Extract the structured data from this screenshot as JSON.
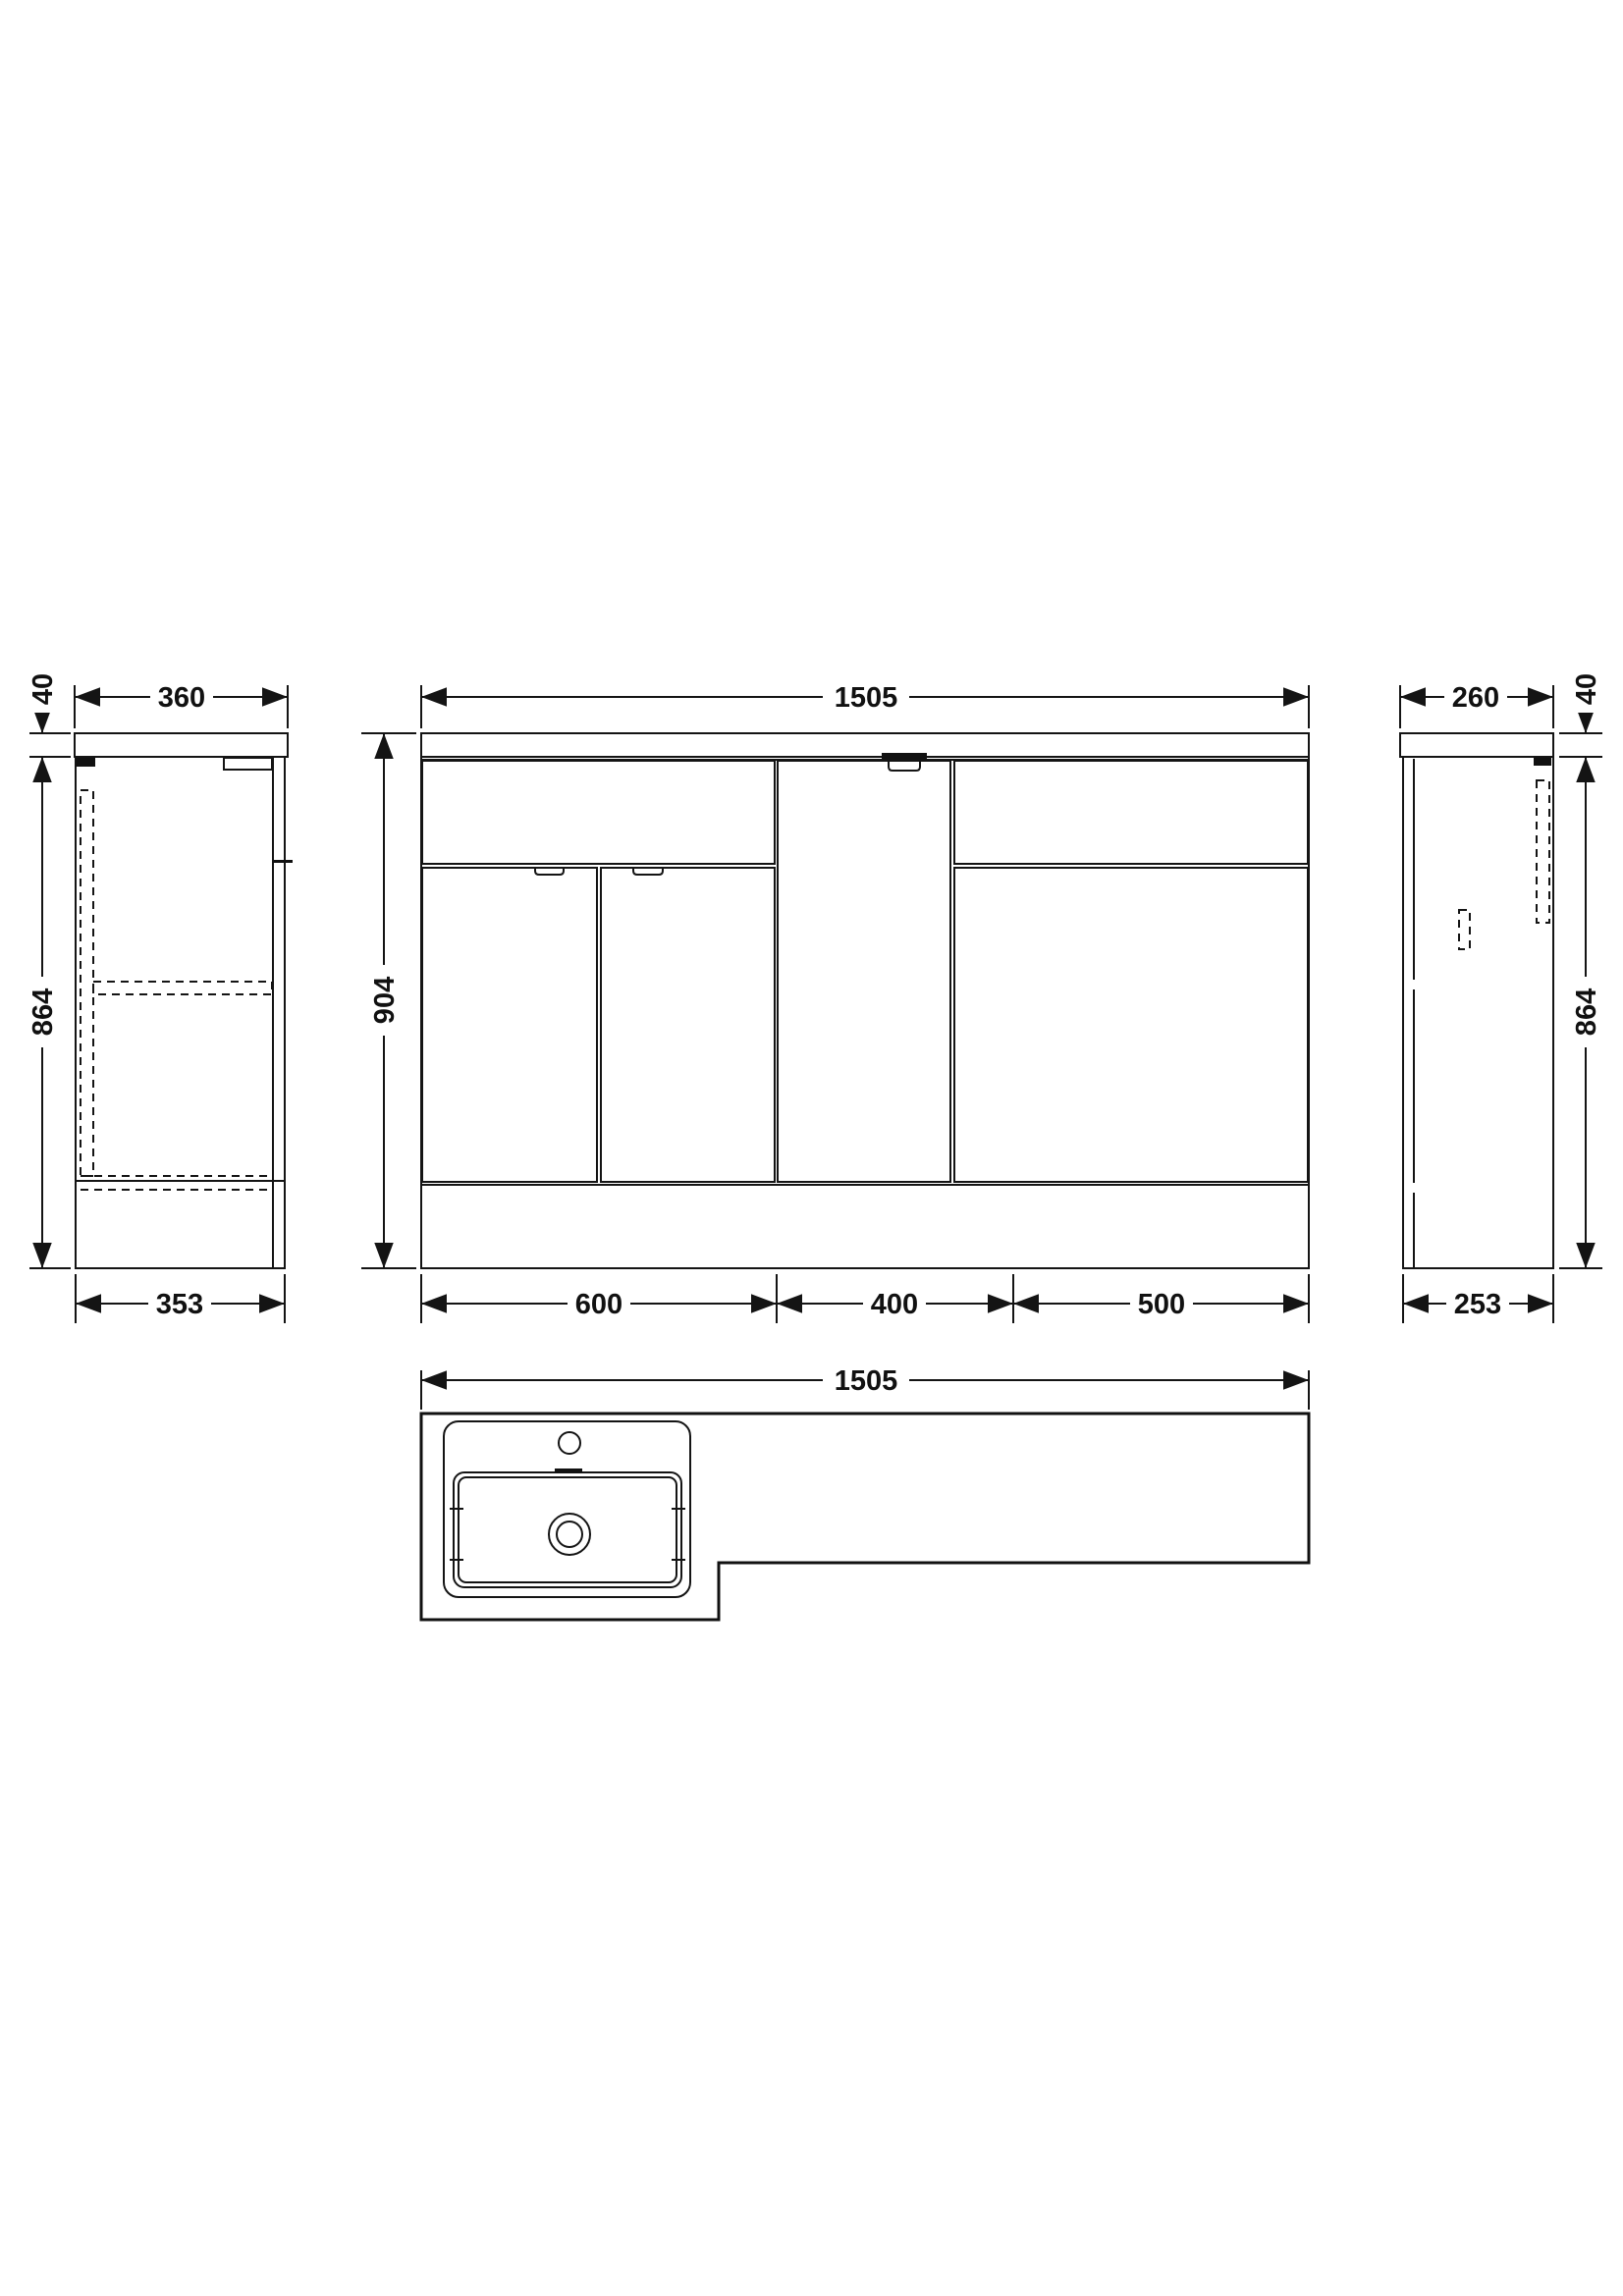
{
  "drawing": {
    "type": "technical-cad-drawing",
    "subject": "combination-vanity-basin-wc-unit",
    "background_color": "#ffffff",
    "line_color": "#141414",
    "views": {
      "left_side_view": {
        "dims": {
          "top_width": "360",
          "top_thickness": "40",
          "body_height": "864",
          "bottom_width": "353"
        }
      },
      "front_view": {
        "dims": {
          "total_width": "1505",
          "total_height": "904",
          "bottom_segments": [
            "600",
            "400",
            "500"
          ]
        }
      },
      "right_side_view": {
        "dims": {
          "top_width": "260",
          "top_thickness": "40",
          "body_height": "864",
          "bottom_width": "253"
        }
      },
      "plan_view": {
        "dims": {
          "total_width": "1505"
        }
      }
    }
  }
}
